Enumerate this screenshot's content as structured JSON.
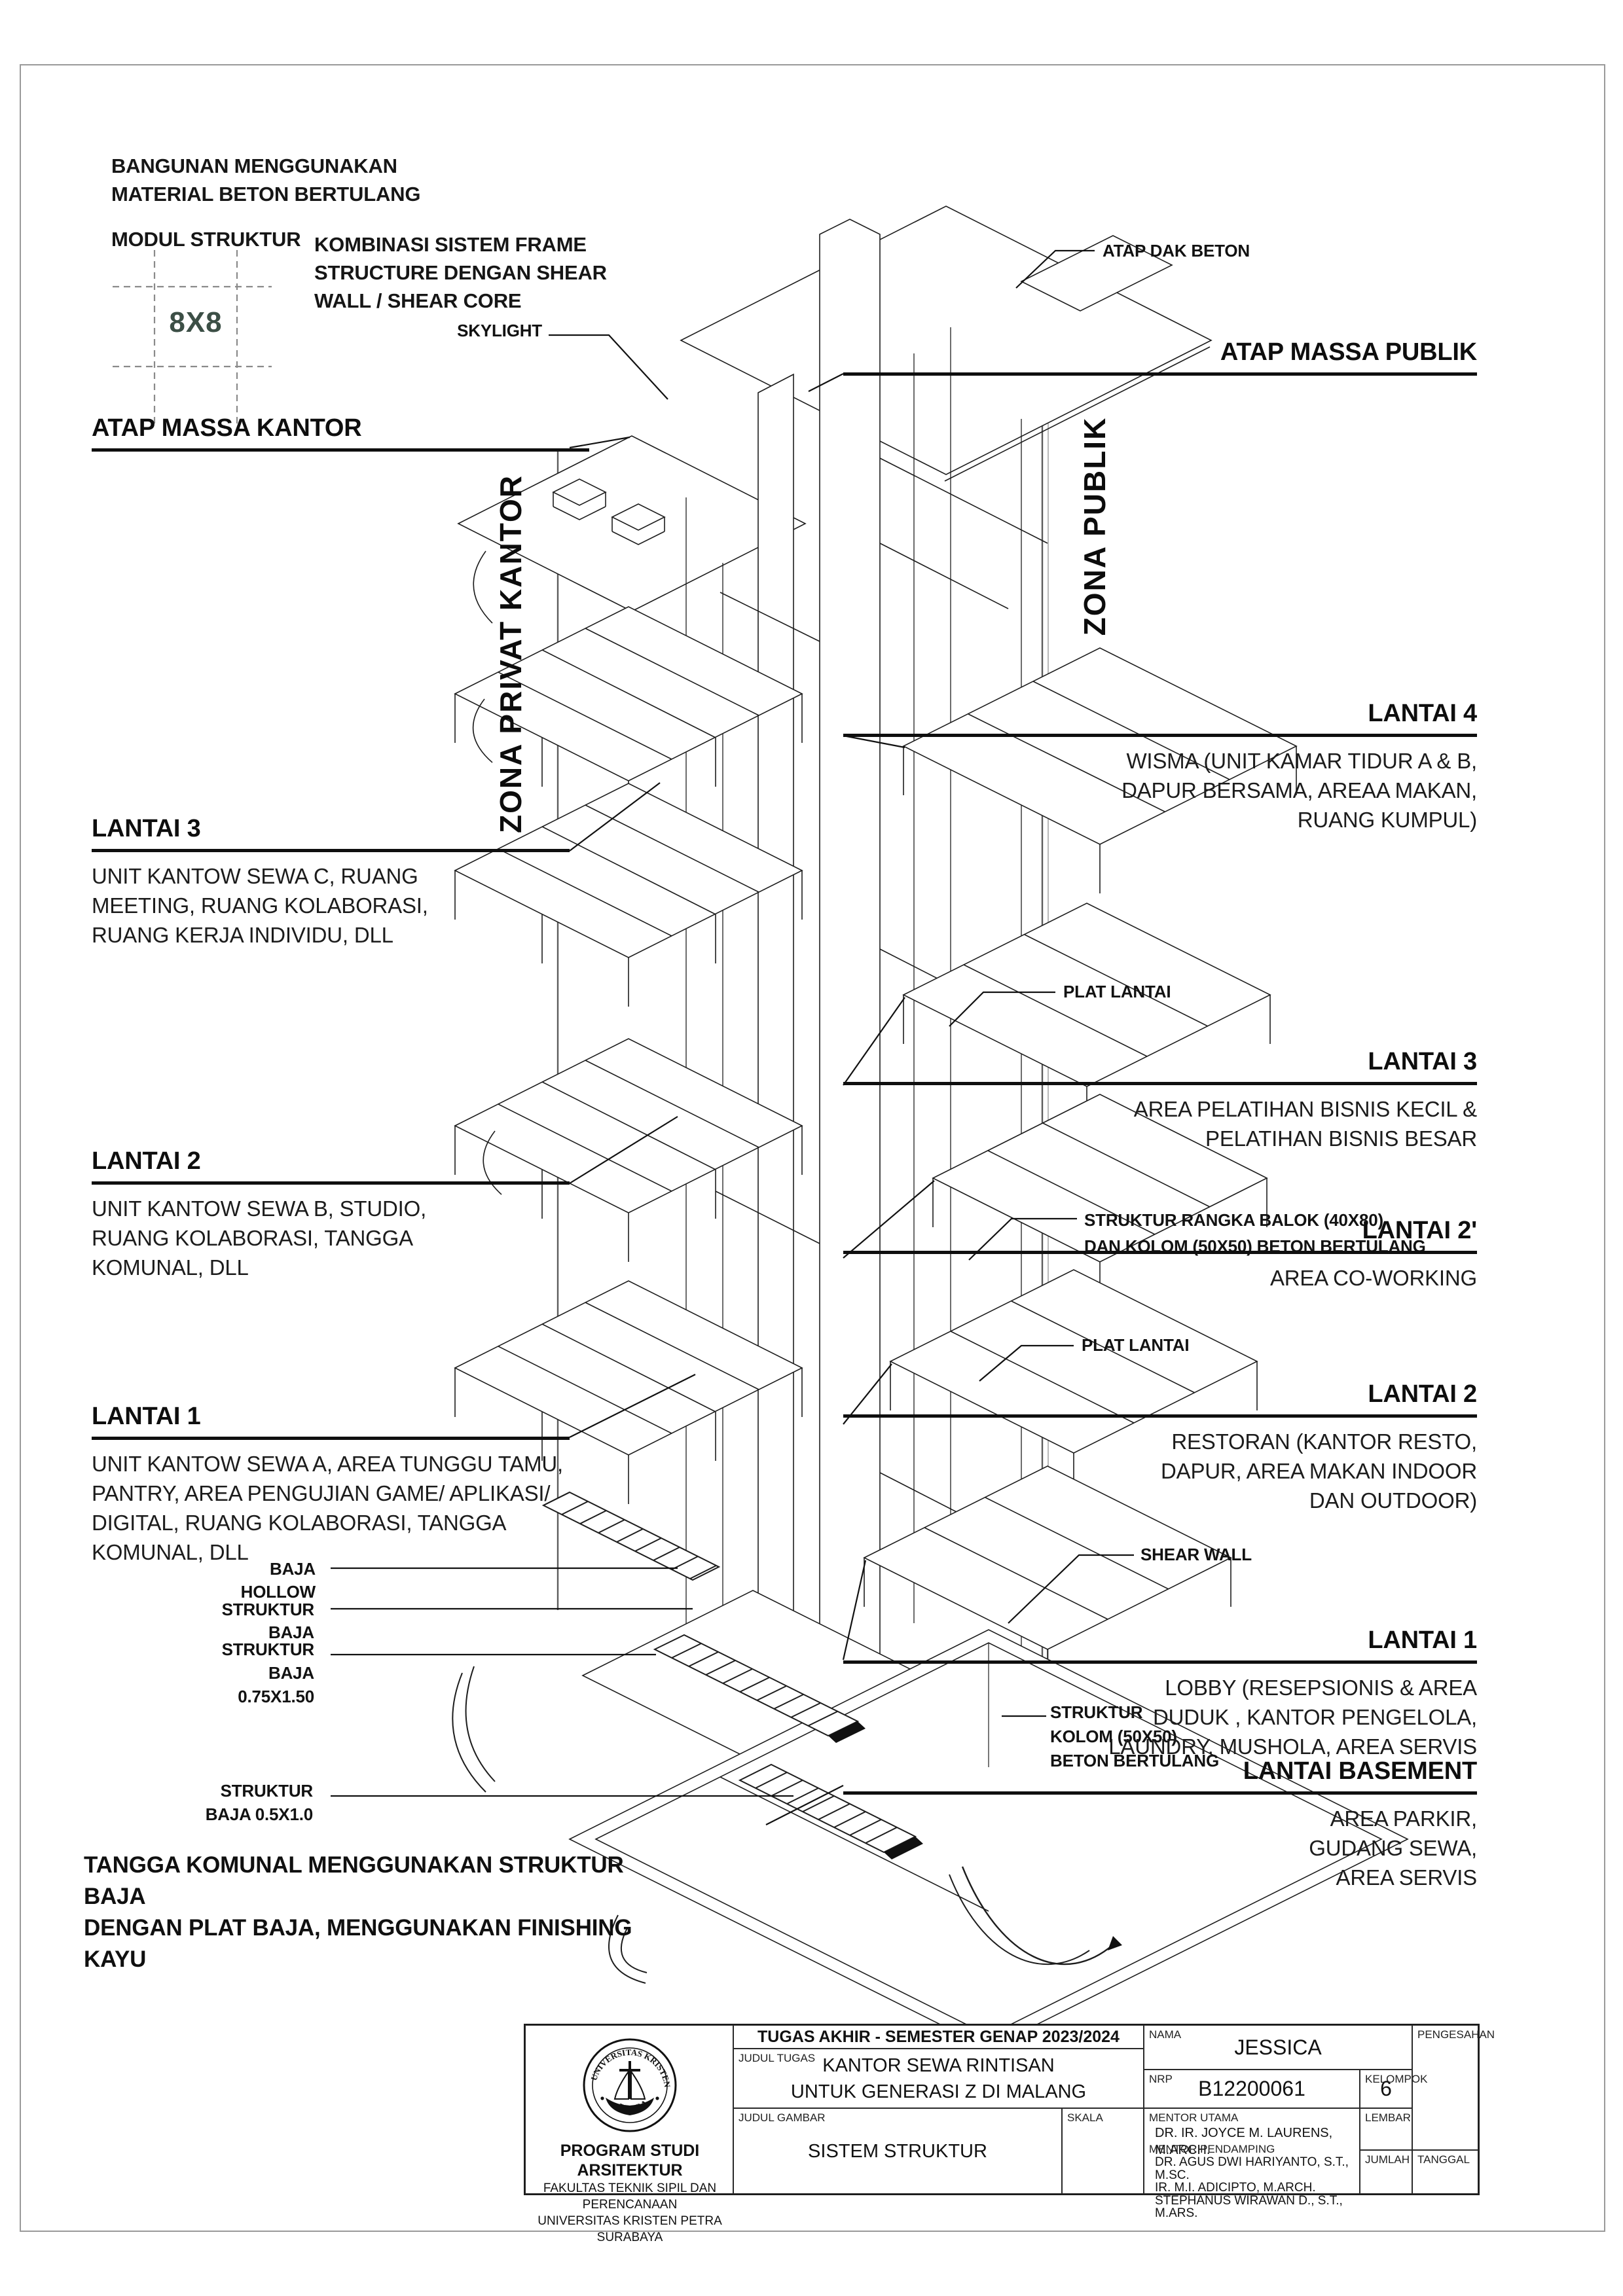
{
  "accent_color": "#3c4f46",
  "notes": {
    "material": "BANGUNAN MENGGUNAKAN\nMATERIAL BETON BERTULANG",
    "module_label": "MODUL STRUKTUR",
    "module_value": "8X8",
    "system": "KOMBINASI SISTEM FRAME\nSTRUCTURE DENGAN SHEAR\nWALL / SHEAR CORE",
    "stairs": "TANGGA KOMUNAL MENGGUNAKAN STRUKTUR BAJA\nDENGAN PLAT BAJA, MENGGUNAKAN FINISHING KAYU"
  },
  "zones": {
    "left": "ZONA PRIVAT KANTOR",
    "right": "ZONA PUBLIK"
  },
  "callouts": {
    "skylight": "SKYLIGHT",
    "atap_dak_beton": "ATAP DAK BETON",
    "plat_lantai_upper": "PLAT LANTAI",
    "plat_lantai_lower": "PLAT LANTAI",
    "struktur_rangka": "STRUKTUR RANGKA BALOK (40X80)\nDAN KOLOM (50X50) BETON BERTULANG",
    "shear_wall": "SHEAR WALL",
    "struktur_kolom": "STRUKTUR\nKOLOM (50X50)\nBETON BERTULANG",
    "baja_hollow": "BAJA HOLLOW",
    "struktur_baja": "STRUKTUR BAJA",
    "struktur_baja_075": "STRUKTUR\nBAJA 0.75X1.50",
    "struktur_baja_05": "STRUKTUR\nBAJA 0.5X1.0"
  },
  "levels_left": [
    {
      "title": "ATAP MASSA KANTOR",
      "desc": ""
    },
    {
      "title": "LANTAI 3",
      "desc": "UNIT KANTOW SEWA C, RUANG\nMEETING, RUANG KOLABORASI,\nRUANG KERJA INDIVIDU, DLL"
    },
    {
      "title": "LANTAI 2",
      "desc": "UNIT KANTOW SEWA B, STUDIO,\nRUANG KOLABORASI, TANGGA\nKOMUNAL, DLL"
    },
    {
      "title": "LANTAI 1",
      "desc": "UNIT KANTOW SEWA A, AREA TUNGGU TAMU,\nPANTRY, AREA PENGUJIAN GAME/ APLIKASI/\nDIGITAL, RUANG KOLABORASI, TANGGA\nKOMUNAL, DLL"
    }
  ],
  "levels_right": [
    {
      "title": "ATAP MASSA PUBLIK",
      "desc": ""
    },
    {
      "title": "LANTAI 4",
      "desc": "WISMA (UNIT KAMAR TIDUR A & B,\nDAPUR BERSAMA, AREAA MAKAN,\nRUANG KUMPUL)"
    },
    {
      "title": "LANTAI 3",
      "desc": "AREA PELATIHAN BISNIS KECIL &\nPELATIHAN BISNIS BESAR"
    },
    {
      "title": "LANTAI 2'",
      "desc": "AREA CO-WORKING"
    },
    {
      "title": "LANTAI 2",
      "desc": "RESTORAN (KANTOR RESTO,\nDAPUR, AREA MAKAN INDOOR\nDAN OUTDOOR)"
    },
    {
      "title": "LANTAI 1",
      "desc": "LOBBY (RESEPSIONIS & AREA\nDUDUK , KANTOR PENGELOLA,\nLAUNDRY, MUSHOLA, AREA SERVIS"
    },
    {
      "title": "LANTAI BASEMENT",
      "desc": "AREA PARKIR,\nGUDANG SEWA,\nAREA SERVIS"
    }
  ],
  "titleblock": {
    "header": "TUGAS AKHIR - SEMESTER GENAP 2023/2024",
    "labels": {
      "judul_tugas": "JUDUL TUGAS",
      "judul_gambar": "JUDUL GAMBAR",
      "skala": "SKALA",
      "nama": "NAMA",
      "nrp": "NRP",
      "kelompok": "KELOMPOK",
      "mentor_utama": "MENTOR UTAMA",
      "mentor_pendamping": "MENTOR PENDAMPING",
      "lembar": "LEMBAR",
      "jumlah": "JUMLAH",
      "pengesahan": "PENGESAHAN",
      "tanggal": "TANGGAL"
    },
    "judul_tugas_value": "KANTOR SEWA RINTISAN\nUNTUK GENERASI Z DI MALANG",
    "judul_gambar_value": "SISTEM STRUKTUR",
    "nama_value": "JESSICA",
    "nrp_value": "B12200061",
    "kelompok_value": "6",
    "mentor_utama_value": "DR. IR. JOYCE M. LAURENS, M.ARCH.",
    "mentor_pendamping_value": "DR. AGUS DWI HARIYANTO, S.T., M.SC.\nIR. M.I. ADICIPTO, M.ARCH.\nSTEPHANUS WIRAWAN D., S.T., M.ARS.",
    "institution": {
      "seal_top": "UNIVERSITAS KRISTEN",
      "seal_bottom": "PETRA",
      "line1": "PROGRAM STUDI ARSITEKTUR",
      "line2": "FAKULTAS TEKNIK SIPIL DAN PERENCANAAN",
      "line3": "UNIVERSITAS KRISTEN PETRA",
      "line4": "SURABAYA"
    }
  }
}
